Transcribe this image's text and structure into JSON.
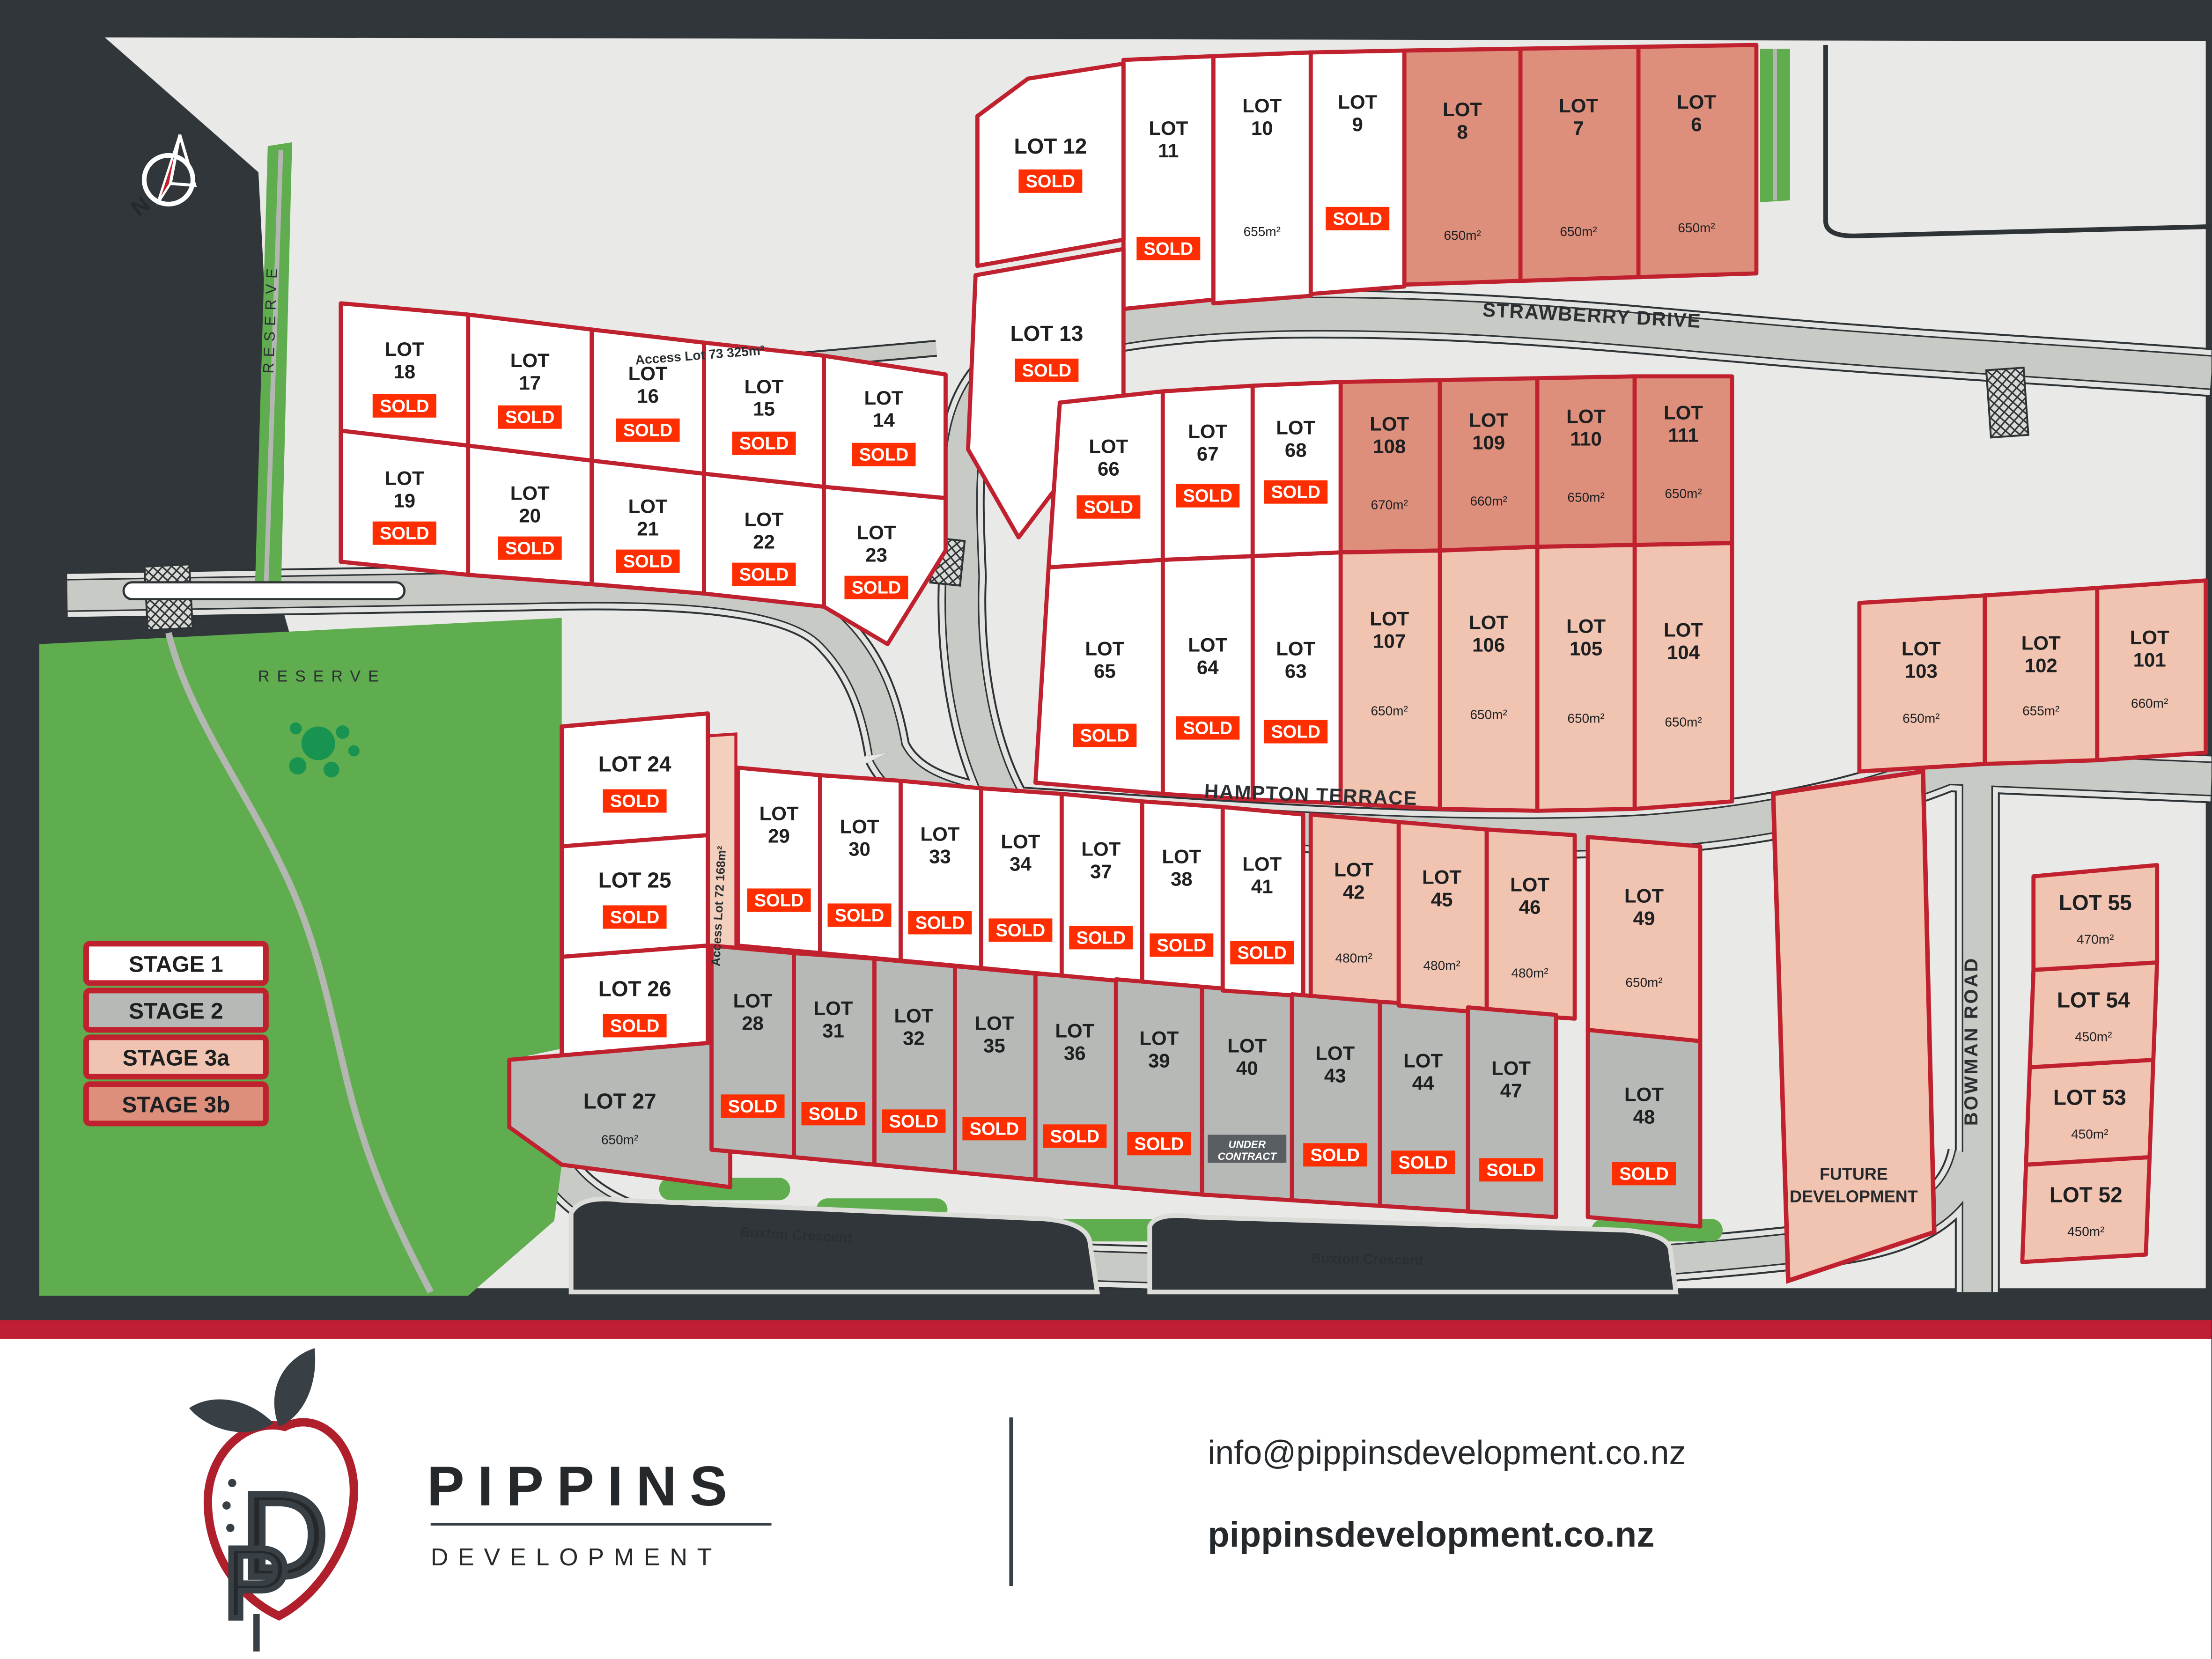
{
  "title": "Pippins Development Site Plan",
  "colors": {
    "background": "#31363a",
    "land": "#e9e9e7",
    "road": "#c8cac6",
    "sidewalk": "#e3e4e1",
    "road_edge": "#2e3336",
    "lot_border": "#c0212f",
    "sold": "#ff2e00",
    "under_contract_bg": "#595e62",
    "stage1": "#ffffff",
    "stage2": "#b6b9b5",
    "stage3a": "#f0c4b1",
    "stage3b": "#de8f7c",
    "access_strip": "#f3cfbd",
    "green": "#60ad4f",
    "tree": "#189350",
    "path": "#b4b6b2",
    "red_bar": "#c01e32",
    "footer_bg": "#ffffff",
    "logo_red": "#b01f2c",
    "logo_dark": "#394045"
  },
  "compass": {
    "label": "N"
  },
  "legend": [
    {
      "label": "STAGE 1",
      "stage": "1"
    },
    {
      "label": "STAGE 2",
      "stage": "2"
    },
    {
      "label": "STAGE 3a",
      "stage": "3a"
    },
    {
      "label": "STAGE 3b",
      "stage": "3b"
    }
  ],
  "streets": [
    {
      "id": "strawberry",
      "name": "STRAWBERRY DRIVE"
    },
    {
      "id": "hampton",
      "name": "HAMPTON TERRACE"
    },
    {
      "id": "bowman",
      "name": "BOWMAN ROAD"
    },
    {
      "id": "buxton_a",
      "name": "Buxton Crescent"
    },
    {
      "id": "buxton_b",
      "name": "Buxton Crescent"
    },
    {
      "id": "access73",
      "name": "Access Lot 73 325m²"
    },
    {
      "id": "access72",
      "name": "Access Lot 72 168m²"
    }
  ],
  "reserves": [
    {
      "id": "west_strip",
      "label": "RESERVE"
    },
    {
      "id": "main",
      "label": "RESERVE"
    }
  ],
  "future_development": {
    "line1": "FUTURE",
    "line2": "DEVELOPMENT"
  },
  "badges": {
    "sold": "SOLD",
    "under_contract_line1": "UNDER",
    "under_contract_line2": "CONTRACT"
  },
  "lots": [
    {
      "id": "6",
      "label": "LOT 6",
      "stage": "3b",
      "status": "available",
      "area": "650m²"
    },
    {
      "id": "7",
      "label": "LOT 7",
      "stage": "3b",
      "status": "available",
      "area": "650m²"
    },
    {
      "id": "8",
      "label": "LOT 8",
      "stage": "3b",
      "status": "available",
      "area": "650m²"
    },
    {
      "id": "9",
      "label": "LOT 9",
      "stage": "1",
      "status": "sold",
      "area": null
    },
    {
      "id": "10",
      "label": "LOT 10",
      "stage": "1",
      "status": "available",
      "area": "655m²"
    },
    {
      "id": "11",
      "label": "LOT 11",
      "stage": "1",
      "status": "sold",
      "area": null
    },
    {
      "id": "12",
      "label": "LOT 12",
      "stage": "1",
      "status": "sold",
      "area": null
    },
    {
      "id": "13",
      "label": "LOT 13",
      "stage": "1",
      "status": "sold",
      "area": null
    },
    {
      "id": "14",
      "label": "LOT 14",
      "stage": "1",
      "status": "sold",
      "area": null
    },
    {
      "id": "15",
      "label": "LOT 15",
      "stage": "1",
      "status": "sold",
      "area": null
    },
    {
      "id": "16",
      "label": "LOT 16",
      "stage": "1",
      "status": "sold",
      "area": null
    },
    {
      "id": "17",
      "label": "LOT 17",
      "stage": "1",
      "status": "sold",
      "area": null
    },
    {
      "id": "18",
      "label": "LOT 18",
      "stage": "1",
      "status": "sold",
      "area": null
    },
    {
      "id": "19",
      "label": "LOT 19",
      "stage": "1",
      "status": "sold",
      "area": null
    },
    {
      "id": "20",
      "label": "LOT 20",
      "stage": "1",
      "status": "sold",
      "area": null
    },
    {
      "id": "21",
      "label": "LOT 21",
      "stage": "1",
      "status": "sold",
      "area": null
    },
    {
      "id": "22",
      "label": "LOT 22",
      "stage": "1",
      "status": "sold",
      "area": null
    },
    {
      "id": "23",
      "label": "LOT 23",
      "stage": "1",
      "status": "sold",
      "area": null
    },
    {
      "id": "24",
      "label": "LOT 24",
      "stage": "1",
      "status": "sold",
      "area": null
    },
    {
      "id": "25",
      "label": "LOT 25",
      "stage": "1",
      "status": "sold",
      "area": null
    },
    {
      "id": "26",
      "label": "LOT 26",
      "stage": "1",
      "status": "sold",
      "area": null
    },
    {
      "id": "27",
      "label": "LOT 27",
      "stage": "2",
      "status": "available",
      "area": "650m²"
    },
    {
      "id": "28",
      "label": "LOT 28",
      "stage": "2",
      "status": "sold",
      "area": null
    },
    {
      "id": "29",
      "label": "LOT 29",
      "stage": "1",
      "status": "sold",
      "area": null
    },
    {
      "id": "30",
      "label": "LOT 30",
      "stage": "1",
      "status": "sold",
      "area": null
    },
    {
      "id": "31",
      "label": "LOT 31",
      "stage": "2",
      "status": "sold",
      "area": null
    },
    {
      "id": "32",
      "label": "LOT 32",
      "stage": "2",
      "status": "sold",
      "area": null
    },
    {
      "id": "33",
      "label": "LOT 33",
      "stage": "1",
      "status": "sold",
      "area": null
    },
    {
      "id": "34",
      "label": "LOT 34",
      "stage": "1",
      "status": "sold",
      "area": null
    },
    {
      "id": "35",
      "label": "LOT 35",
      "stage": "2",
      "status": "sold",
      "area": null
    },
    {
      "id": "36",
      "label": "LOT 36",
      "stage": "2",
      "status": "sold",
      "area": null
    },
    {
      "id": "37",
      "label": "LOT 37",
      "stage": "1",
      "status": "sold",
      "area": null
    },
    {
      "id": "38",
      "label": "LOT 38",
      "stage": "1",
      "status": "sold",
      "area": null
    },
    {
      "id": "39",
      "label": "LOT 39",
      "stage": "2",
      "status": "sold",
      "area": null
    },
    {
      "id": "40",
      "label": "LOT 40",
      "stage": "2",
      "status": "under_contract",
      "area": null
    },
    {
      "id": "41",
      "label": "LOT 41",
      "stage": "1",
      "status": "sold",
      "area": null
    },
    {
      "id": "42",
      "label": "LOT 42",
      "stage": "3a",
      "status": "available",
      "area": "480m²"
    },
    {
      "id": "43",
      "label": "LOT 43",
      "stage": "2",
      "status": "sold",
      "area": null
    },
    {
      "id": "44",
      "label": "LOT 44",
      "stage": "2",
      "status": "sold",
      "area": null
    },
    {
      "id": "45",
      "label": "LOT 45",
      "stage": "3a",
      "status": "available",
      "area": "480m²"
    },
    {
      "id": "46",
      "label": "LOT 46",
      "stage": "3a",
      "status": "available",
      "area": "480m²"
    },
    {
      "id": "47",
      "label": "LOT 47",
      "stage": "2",
      "status": "sold",
      "area": null
    },
    {
      "id": "48",
      "label": "LOT 48",
      "stage": "2",
      "status": "sold",
      "area": null
    },
    {
      "id": "49",
      "label": "LOT 49",
      "stage": "3a",
      "status": "available",
      "area": "650m²"
    },
    {
      "id": "52",
      "label": "LOT 52",
      "stage": "3a",
      "status": "available",
      "area": "450m²"
    },
    {
      "id": "53",
      "label": "LOT 53",
      "stage": "3a",
      "status": "available",
      "area": "450m²"
    },
    {
      "id": "54",
      "label": "LOT 54",
      "stage": "3a",
      "status": "available",
      "area": "450m²"
    },
    {
      "id": "55",
      "label": "LOT 55",
      "stage": "3a",
      "status": "available",
      "area": "470m²"
    },
    {
      "id": "63",
      "label": "LOT 63",
      "stage": "1",
      "status": "sold",
      "area": null
    },
    {
      "id": "64",
      "label": "LOT 64",
      "stage": "1",
      "status": "sold",
      "area": null
    },
    {
      "id": "65",
      "label": "LOT 65",
      "stage": "1",
      "status": "sold",
      "area": null
    },
    {
      "id": "66",
      "label": "LOT 66",
      "stage": "1",
      "status": "sold",
      "area": null
    },
    {
      "id": "67",
      "label": "LOT 67",
      "stage": "1",
      "status": "sold",
      "area": null
    },
    {
      "id": "68",
      "label": "LOT 68",
      "stage": "1",
      "status": "sold",
      "area": null
    },
    {
      "id": "101",
      "label": "LOT 101",
      "stage": "3a",
      "status": "available",
      "area": "660m²"
    },
    {
      "id": "102",
      "label": "LOT 102",
      "stage": "3a",
      "status": "available",
      "area": "655m²"
    },
    {
      "id": "103",
      "label": "LOT 103",
      "stage": "3a",
      "status": "available",
      "area": "650m²"
    },
    {
      "id": "104",
      "label": "LOT 104",
      "stage": "3a",
      "status": "available",
      "area": "650m²"
    },
    {
      "id": "105",
      "label": "LOT 105",
      "stage": "3a",
      "status": "available",
      "area": "650m²"
    },
    {
      "id": "106",
      "label": "LOT 106",
      "stage": "3a",
      "status": "available",
      "area": "650m²"
    },
    {
      "id": "107",
      "label": "LOT 107",
      "stage": "3a",
      "status": "available",
      "area": "650m²"
    },
    {
      "id": "108",
      "label": "LOT 108",
      "stage": "3b",
      "status": "available",
      "area": "670m²"
    },
    {
      "id": "109",
      "label": "LOT 109",
      "stage": "3b",
      "status": "available",
      "area": "660m²"
    },
    {
      "id": "110",
      "label": "LOT 110",
      "stage": "3b",
      "status": "available",
      "area": "650m²"
    },
    {
      "id": "111",
      "label": "LOT 111",
      "stage": "3b",
      "status": "available",
      "area": "650m²"
    }
  ],
  "footer": {
    "brand": "PIPPINS",
    "brand_sub": "DEVELOPMENT",
    "email": "info@pippinsdevelopment.co.nz",
    "website": "pippinsdevelopment.co.nz"
  }
}
